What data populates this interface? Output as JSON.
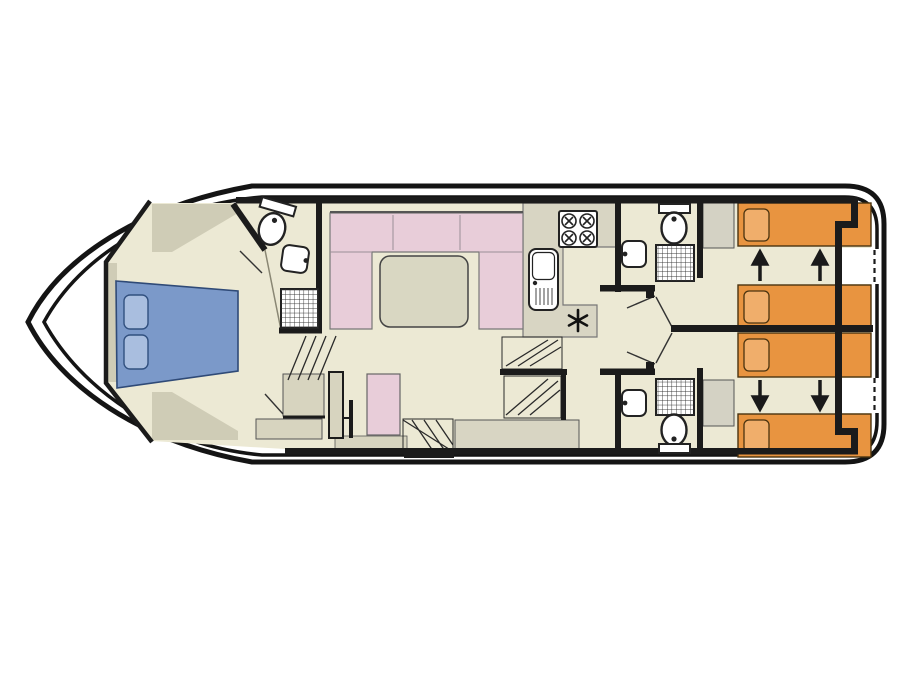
{
  "diagram": {
    "type": "houseboat-floorplan-top-view",
    "orientation": "bow-left-stern-right",
    "levels": 1
  },
  "palette": {
    "page_bg": "#ffffff",
    "white": "#ffffff",
    "hull_line": "#141414",
    "wall": "#1b1b1b",
    "deck_khaki": "#d7d4bf",
    "wall_wedge": "#cfccb6",
    "floor": "#ece9d4",
    "counter": "#d8d5c3",
    "furniture_gray": "#d4d2c4",
    "sofa_pink": "#e8cdd9",
    "table_gray": "#d9d7c2",
    "bed_blue": "#7b99c9",
    "pillow_blue": "#a9bedf",
    "bed_orange": "#e89440",
    "pillow_orange": "#f0ae6b"
  },
  "rooms": [
    {
      "name": "bow-cabin",
      "fixtures": [
        "double-bed-blue",
        "pillow",
        "pillow",
        "steps-hatch",
        "seat-cabinet"
      ]
    },
    {
      "name": "fore-bathroom",
      "fixtures": [
        "toilet",
        "washbasin",
        "shower-grid",
        "door-swing"
      ]
    },
    {
      "name": "saloon",
      "fixtures": [
        "u-shaped-sofa-pink",
        "table"
      ]
    },
    {
      "name": "helm",
      "fixtures": [
        "helm-seat-pink",
        "console-cabinet",
        "entry-steps",
        "threshold",
        "side-platform"
      ]
    },
    {
      "name": "galley",
      "fixtures": [
        "hob-4-burners",
        "sink-with-drainer",
        "l-shaped-worktop",
        "appliance-asterisk"
      ]
    },
    {
      "name": "mid-stairs",
      "fixtures": [
        "stair-flight-upper",
        "stair-flight-lower"
      ]
    },
    {
      "name": "corridor",
      "fixtures": [
        "door-swing",
        "door-swing",
        "door-swing",
        "door-swing"
      ]
    },
    {
      "name": "aft-bathroom-top",
      "fixtures": [
        "washbasin",
        "toilet",
        "shower-grid"
      ]
    },
    {
      "name": "aft-bathroom-bottom",
      "fixtures": [
        "washbasin",
        "toilet",
        "shower-grid"
      ]
    },
    {
      "name": "aft-cabin-top",
      "fixtures": [
        "wardrobe",
        "single-bed-orange",
        "single-bed-orange",
        "slide-arrow-up",
        "slide-arrow-up"
      ]
    },
    {
      "name": "aft-cabin-bottom",
      "fixtures": [
        "wardrobe",
        "single-bed-orange",
        "single-bed-orange",
        "slide-arrow-down",
        "slide-arrow-down"
      ]
    },
    {
      "name": "stern",
      "fixtures": [
        "dashed-opening",
        "dashed-opening"
      ]
    }
  ],
  "counts": {
    "beds_double": 1,
    "beds_single": 4,
    "toilets": 3,
    "showers": 3,
    "washbasins": 3,
    "slide_arrows": 4
  }
}
